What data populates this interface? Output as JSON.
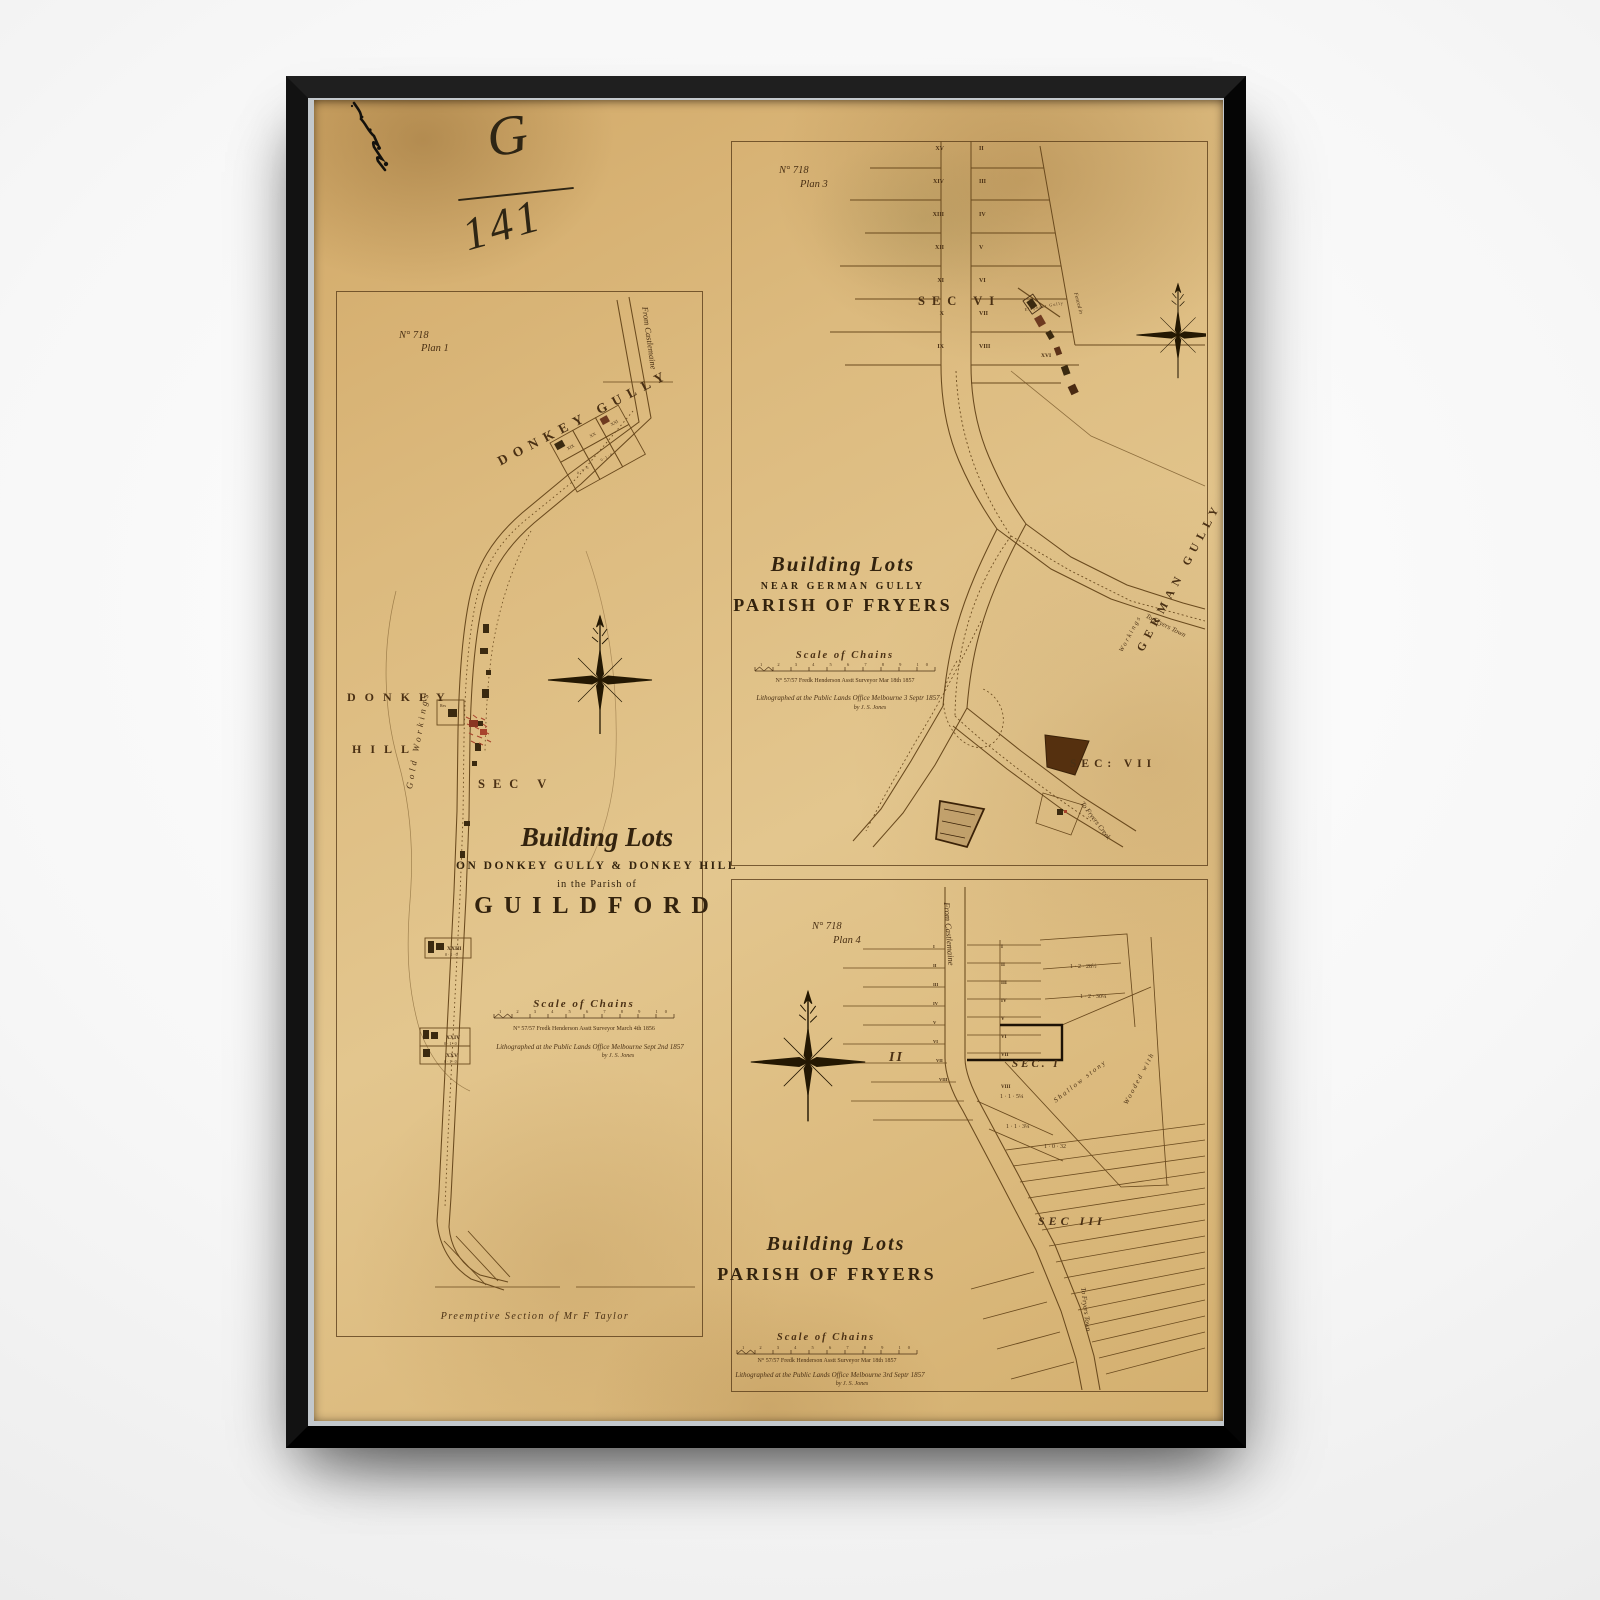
{
  "colors": {
    "paper": "#debb7f",
    "ink": "#53381b",
    "red_marks": "#a8432c",
    "frame": "#0a0a0a"
  },
  "annotations": {
    "file_letter": "G",
    "file_number": "141"
  },
  "plan1": {
    "no": "N° 718",
    "plan": "Plan 1",
    "from_castlemaine": "From Castlemaine",
    "donkey_gully": "DONKEY GULLY",
    "donkey": "DONKEY",
    "hill": "HILL",
    "gold_workings": "Gold Workings",
    "sec_v": "SEC V",
    "title_script": "Building Lots",
    "title_on": "ON DONKEY GULLY & DONKEY HILL",
    "title_parish": "in the Parish of",
    "title_name": "GUILDFORD",
    "scale_label": "Scale of Chains",
    "ruler_numbers": "1 2 3 4 5 6 7 8 9 10",
    "survey_note": "N° 57/57    Fredk Henderson    Asstt Surveyor    March 4th 1856",
    "litho": "Lithographed at the Public Lands Office Melbourne Sept 2nd 1857",
    "litho_by": "by J. S. Jones",
    "preemptive": "Preemptive Section of Mr F Taylor",
    "lots": {
      "xxiii": "XXIII",
      "xxiv": "XXIV",
      "xxv": "XXV"
    },
    "cluster": [
      "XIX",
      "XX",
      "XXI"
    ],
    "acre_small": "0 · 1 · 0",
    "res": "Res"
  },
  "plan3": {
    "no": "N° 718",
    "plan": "Plan 3",
    "sec_vi": "SEC VI",
    "sec_vii": "SEC: VII",
    "left_lots": [
      "XV",
      "XIV",
      "XIII",
      "XII",
      "XI",
      "X",
      "IX"
    ],
    "right_lots": [
      "II",
      "III",
      "IV",
      "V",
      "VI",
      "VII",
      "VIII"
    ],
    "xvi": "XVI",
    "cluster_label": "Elephant Gully",
    "fenced": "Fenced in",
    "german_gully": "GERMAN GULLY",
    "workings": "Workings",
    "to_town": "To Fryers Town",
    "to_creek": "To Fryers Creek",
    "title_script": "Building Lots",
    "title_near": "NEAR GERMAN GULLY",
    "title_parish": "PARISH OF FRYERS",
    "scale_label": "Scale of Chains",
    "ruler_numbers": "1 2 3 4 5 6 7 8 9 10",
    "survey_note": "N° 57/57    Fredk Henderson    Asstt Surveyor    Mar 18th 1857",
    "litho": "Lithographed at the Public Lands Office Melbourne 3 Septr 1857",
    "litho_by": "by J. S. Jones"
  },
  "plan4": {
    "no": "N° 718",
    "plan": "Plan 4",
    "from_castlemaine": "From Castlemaine",
    "sec_i": "SEC. I",
    "sec_iii": "SEC III",
    "big_ii": "II",
    "right_lots": [
      "I",
      "II",
      "III",
      "IV",
      "V",
      "VI",
      "VII"
    ],
    "viii": "VIII",
    "left_lots": [
      "I",
      "II",
      "III",
      "IV",
      "V",
      "VI",
      "VII",
      "VIII"
    ],
    "acre1": "1 · 2 · 28½",
    "acre2": "1 · 2 · 30¼",
    "acre3": "1 · 1 · 5¼",
    "acre4": "1 · 1 · 3¼",
    "acre5": "1 · 0 · 32",
    "shallow": "Shallow stony",
    "wooded": "Wooded with",
    "to_town": "To Fryers Town",
    "title_script": "Building Lots",
    "title_parish": "PARISH OF FRYERS",
    "scale_label": "Scale of Chains",
    "ruler_numbers": "1 2 3 4 5 6 7 8 9 10",
    "survey_note": "N° 57/57    Fredk Henderson    Asstt Surveyor    Mar 18th 1857",
    "litho": "Lithographed at the Public Lands Office Melbourne 3rd Septr 1857",
    "litho_by": "by J. S. Jones"
  }
}
